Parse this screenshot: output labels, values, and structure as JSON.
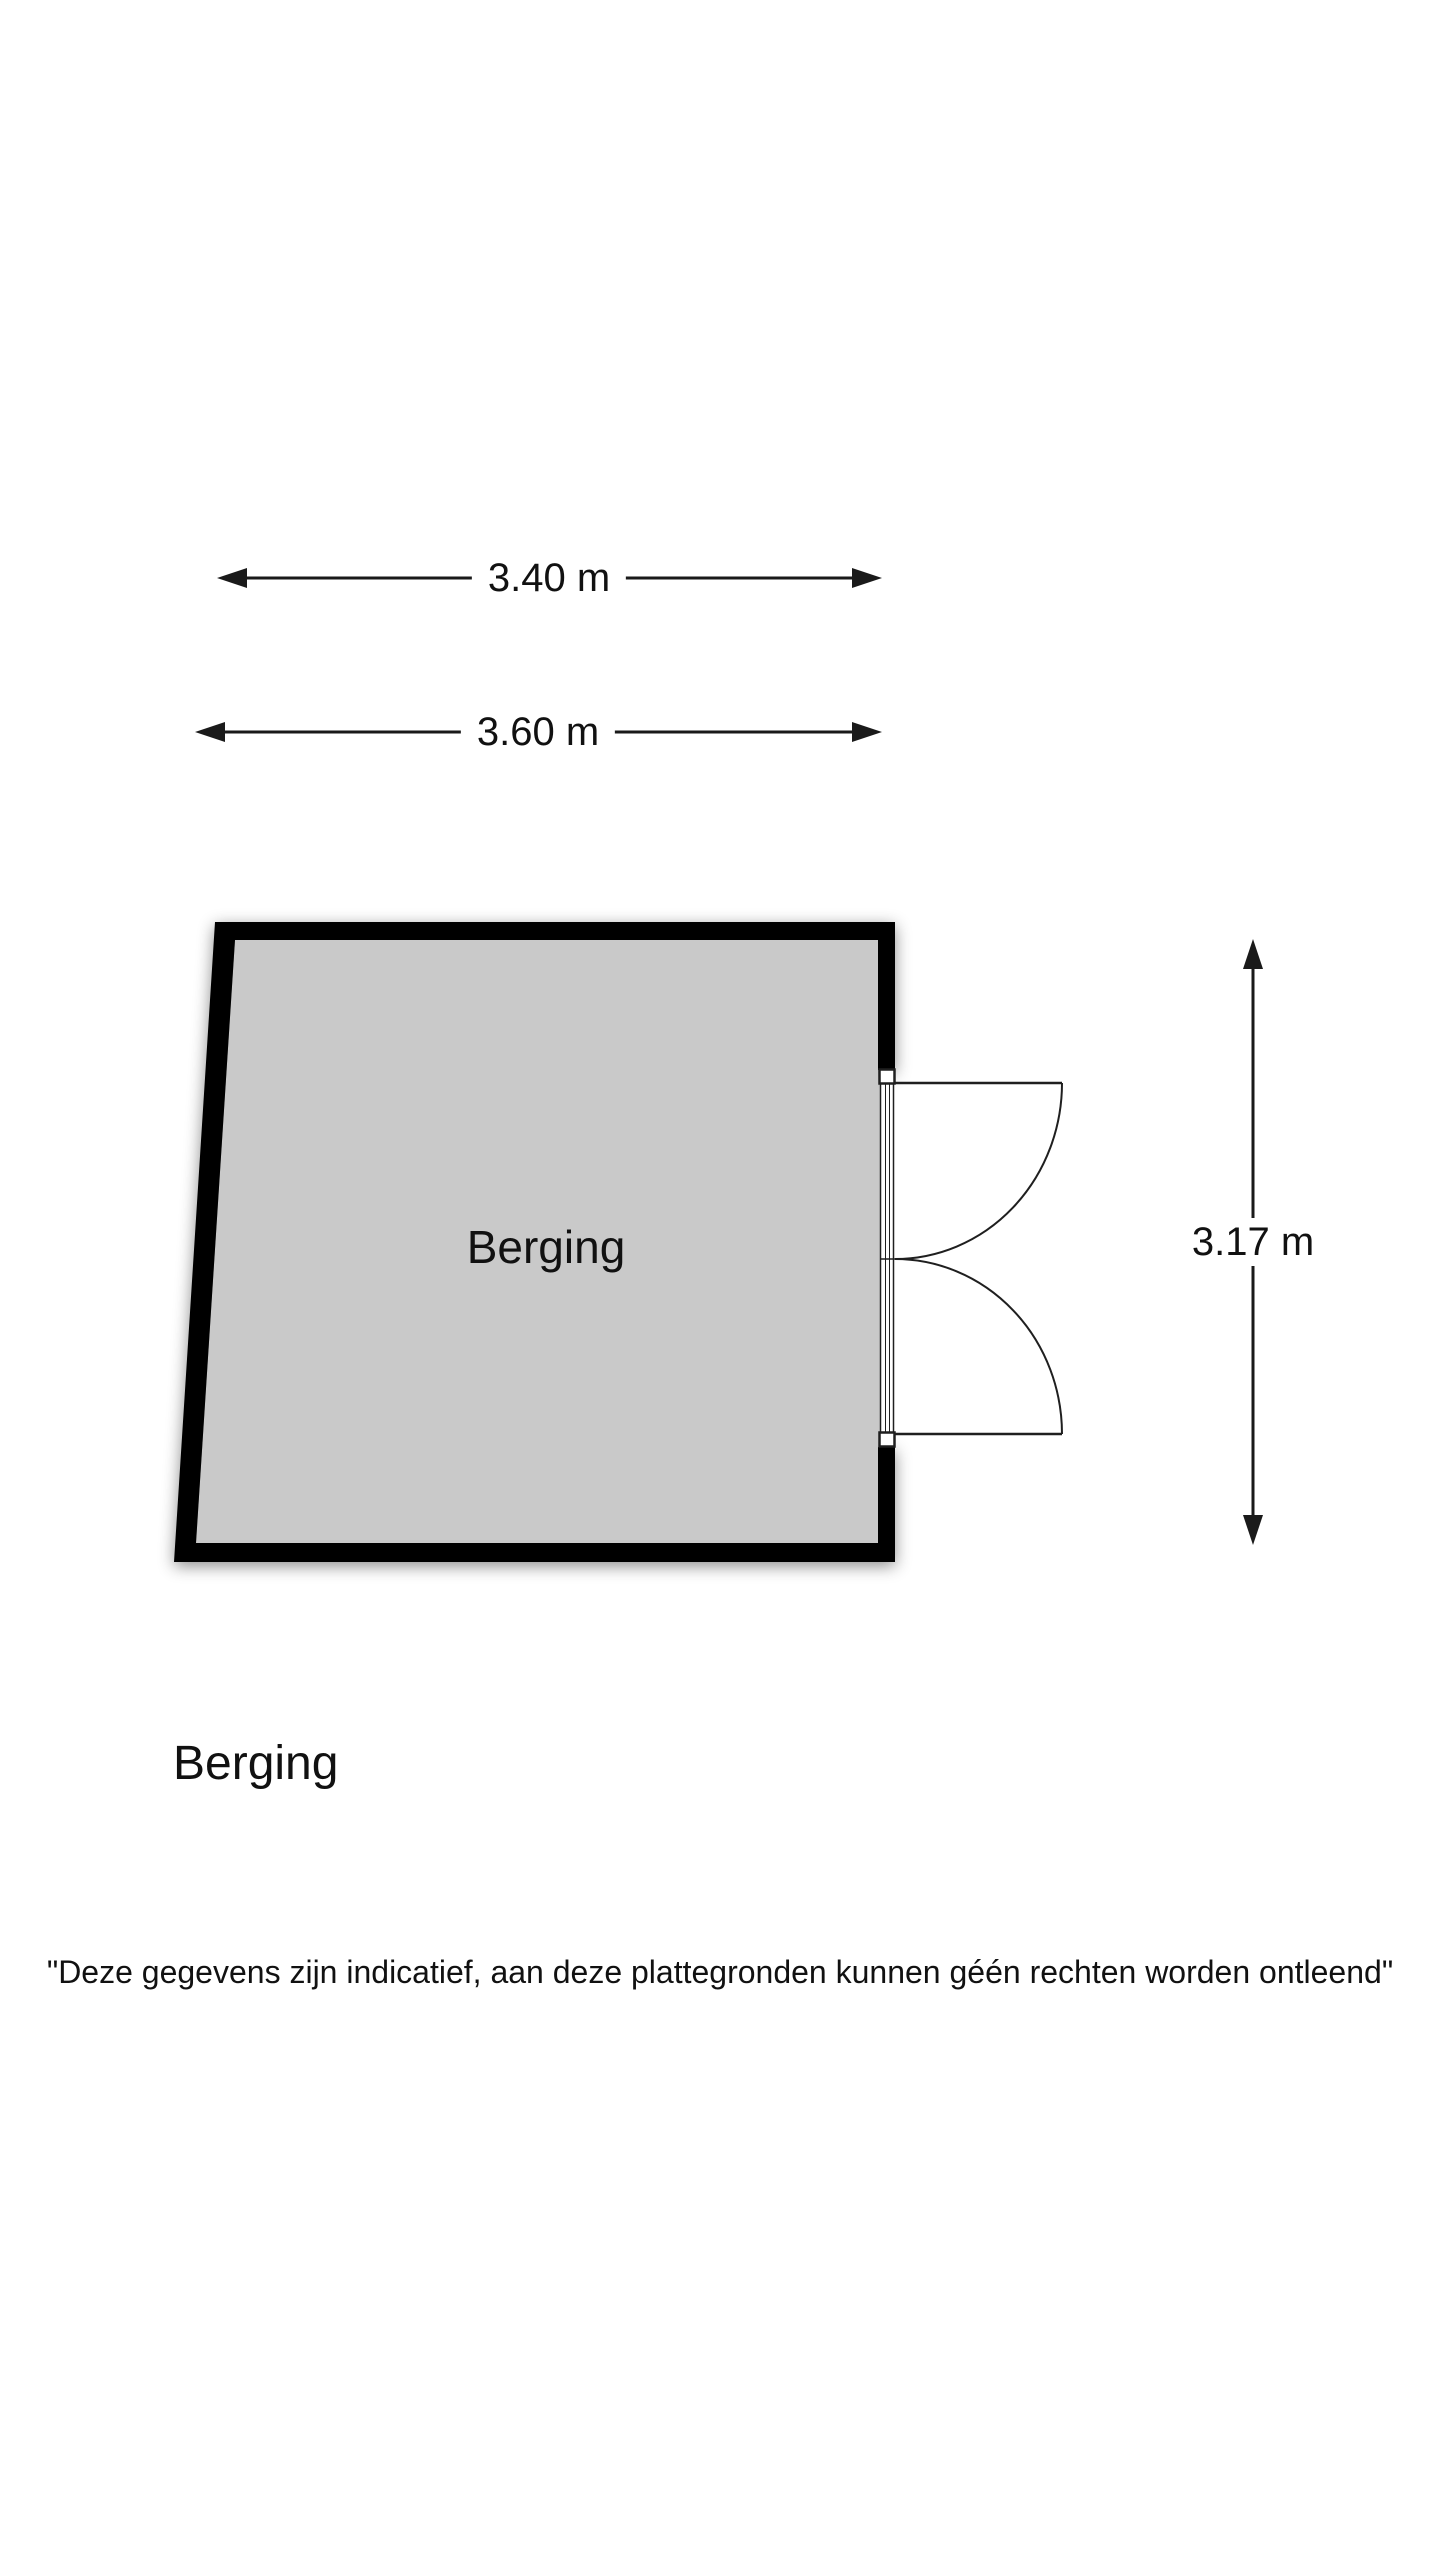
{
  "page": {
    "background_color": "#ffffff"
  },
  "floor_plan": {
    "room_label": "Berging",
    "title": "Berging",
    "room_fill_color": "#c9c9c9",
    "wall_color": "#000000",
    "line_color": "#1f1f1f",
    "dimensions": {
      "top_width": "3.40 m",
      "bottom_width": "3.60 m",
      "right_height": "3.17 m"
    },
    "door": {
      "type": "double-door",
      "swing": "outward-right"
    }
  },
  "disclaimer": "\"Deze gegevens zijn indicatief, aan deze plattegronden kunnen géén rechten worden ontleend\""
}
